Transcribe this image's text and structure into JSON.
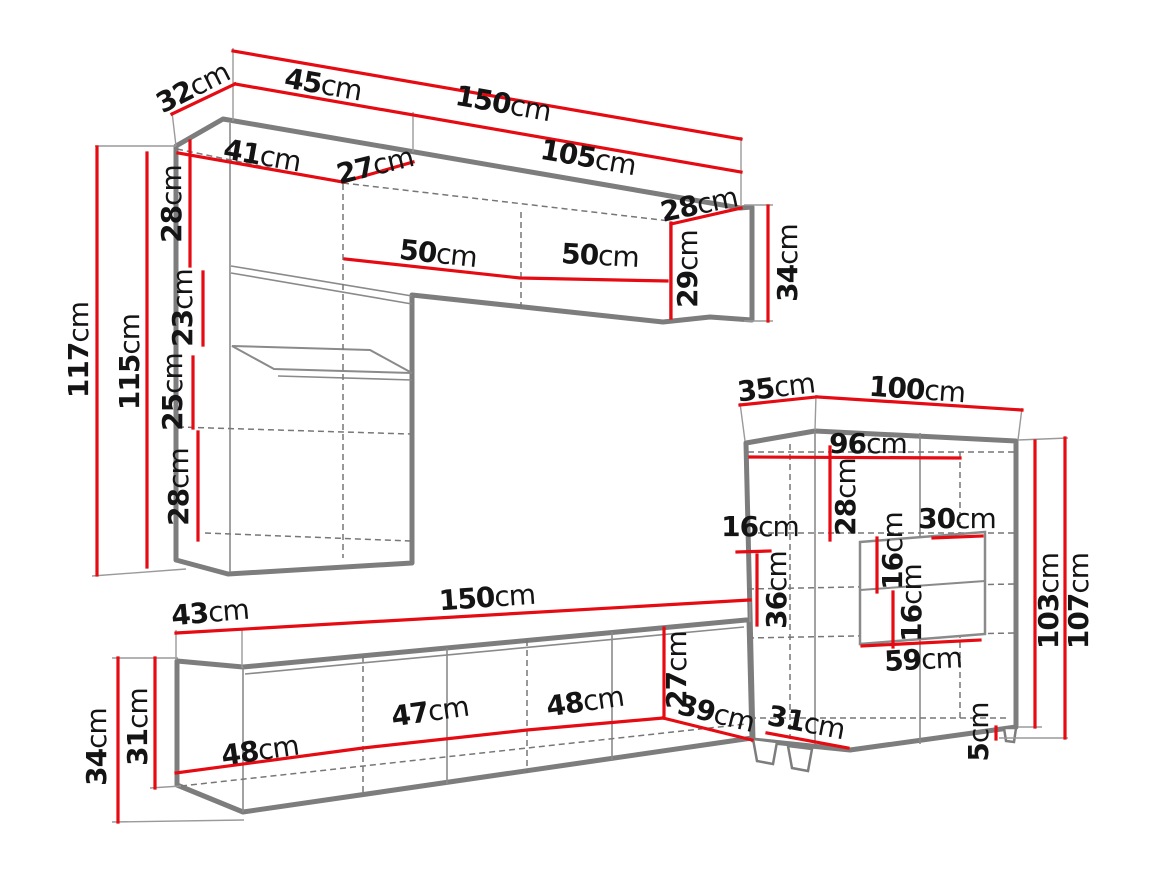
{
  "meta": {
    "unit": "cm",
    "diagram_kind": "furniture dimension drawing"
  },
  "colors": {
    "dimension_line": "#e60b12",
    "furniture_outline": "#7d7d7d",
    "label_text": "#141414",
    "background": "#ffffff"
  },
  "dims": {
    "top_depth_32": {
      "value": "32",
      "unit": "cm"
    },
    "top_width_45": {
      "value": "45",
      "unit": "cm"
    },
    "top_width_150": {
      "value": "150",
      "unit": "cm"
    },
    "top_width_105": {
      "value": "105",
      "unit": "cm"
    },
    "top_inner_41": {
      "value": "41",
      "unit": "cm"
    },
    "top_inner_27": {
      "value": "27",
      "unit": "cm"
    },
    "top_left_h_28": {
      "value": "28",
      "unit": "cm"
    },
    "shelf_door_50_l": {
      "value": "50",
      "unit": "cm"
    },
    "shelf_door_50_r": {
      "value": "50",
      "unit": "cm"
    },
    "shelf_end_top_28": {
      "value": "28",
      "unit": "cm"
    },
    "shelf_end_h_29": {
      "value": "29",
      "unit": "cm"
    },
    "shelf_end_out_34": {
      "value": "34",
      "unit": "cm"
    },
    "col_h_117": {
      "value": "117",
      "unit": "cm"
    },
    "col_h_115": {
      "value": "115",
      "unit": "cm"
    },
    "col_seg_23": {
      "value": "23",
      "unit": "cm"
    },
    "col_seg_25": {
      "value": "25",
      "unit": "cm"
    },
    "col_seg_28": {
      "value": "28",
      "unit": "cm"
    },
    "cab_depth_35": {
      "value": "35",
      "unit": "cm"
    },
    "cab_width_100": {
      "value": "100",
      "unit": "cm"
    },
    "cab_inner_96": {
      "value": "96",
      "unit": "cm"
    },
    "cab_seg_28": {
      "value": "28",
      "unit": "cm"
    },
    "cab_left_16": {
      "value": "16",
      "unit": "cm"
    },
    "cab_seg_36": {
      "value": "36",
      "unit": "cm"
    },
    "niche_16_a": {
      "value": "16",
      "unit": "cm"
    },
    "niche_w_30": {
      "value": "30",
      "unit": "cm"
    },
    "niche_16_b": {
      "value": "16",
      "unit": "cm"
    },
    "niche_w_59": {
      "value": "59",
      "unit": "cm"
    },
    "cab_h_103": {
      "value": "103",
      "unit": "cm"
    },
    "cab_h_107": {
      "value": "107",
      "unit": "cm"
    },
    "cab_foot_5": {
      "value": "5",
      "unit": "cm"
    },
    "stand_depth_43": {
      "value": "43",
      "unit": "cm"
    },
    "stand_width_150": {
      "value": "150",
      "unit": "cm"
    },
    "stand_h_34": {
      "value": "34",
      "unit": "cm"
    },
    "stand_h_31": {
      "value": "31",
      "unit": "cm"
    },
    "stand_door_48_a": {
      "value": "48",
      "unit": "cm"
    },
    "stand_door_47": {
      "value": "47",
      "unit": "cm"
    },
    "stand_door_48_b": {
      "value": "48",
      "unit": "cm"
    },
    "stand_end_27": {
      "value": "27",
      "unit": "cm"
    },
    "stand_diag_39": {
      "value": "39",
      "unit": "cm"
    },
    "stand_floor_31": {
      "value": "31",
      "unit": "cm"
    }
  }
}
